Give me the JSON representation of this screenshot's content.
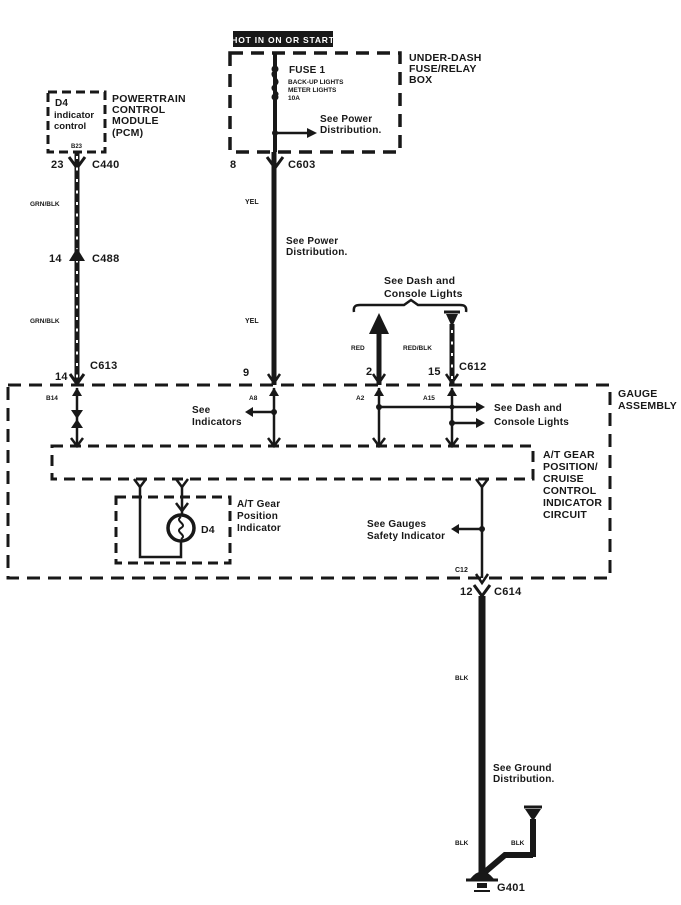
{
  "power": {
    "hot_label": "HOT IN ON OR START",
    "box_label": [
      "UNDER-DASH",
      "FUSE/RELAY",
      "BOX"
    ],
    "fuse_name": "FUSE 1",
    "fuse_detail": [
      "BACK-UP LIGHTS",
      "METER LIGHTS",
      "10A"
    ],
    "see_power": [
      "See Power",
      "Distribution."
    ],
    "pin": "8",
    "connector": "C603"
  },
  "pcm": {
    "box_label": [
      "D4",
      "indicator",
      "control"
    ],
    "pin_tag": "B23",
    "module_label": [
      "POWERTRAIN",
      "CONTROL",
      "MODULE",
      "(PCM)"
    ],
    "c440_pin": "23",
    "c440": "C440",
    "c488_pin": "14",
    "c488": "C488",
    "c613_pin": "14",
    "c613": "C613"
  },
  "wire_labels": {
    "grn_blk_upper": "GRN/BLK",
    "grn_blk_lower": "GRN/BLK",
    "yel_upper": "YEL",
    "yel_lower": "YEL",
    "red": "RED",
    "red_blk": "RED/BLK",
    "blk_main_upper": "BLK",
    "blk_main_lower": "BLK",
    "blk_stub": "BLK"
  },
  "center": {
    "see_power": [
      "See Power",
      "Distribution."
    ],
    "pin_9": "9"
  },
  "dash_lights": {
    "heading": [
      "See Dash and",
      "Console Lights"
    ],
    "pin_2": "2",
    "pin_15": "15",
    "connector": "C612"
  },
  "gauge": {
    "label": [
      "GAUGE",
      "ASSEMBLY"
    ],
    "pin_b14": "B14",
    "pin_a8": "A8",
    "pin_a2": "A2",
    "pin_a15": "A15",
    "see_indicators": [
      "See",
      "Indicators"
    ],
    "see_dash": [
      "See Dash and",
      "Console Lights"
    ],
    "circuit_label": [
      "A/T GEAR",
      "POSITION/",
      "CRUISE",
      "CONTROL",
      "INDICATOR",
      "CIRCUIT"
    ],
    "indicator_box_label": [
      "A/T Gear",
      "Position",
      "Indicator"
    ],
    "bulb": "D4",
    "see_gauges": [
      "See Gauges",
      "Safety Indicator"
    ],
    "pin_c12": "C12"
  },
  "ground": {
    "c614_pin": "12",
    "c614": "C614",
    "see_ground": [
      "See Ground",
      "Distribution."
    ],
    "label": "G401"
  }
}
